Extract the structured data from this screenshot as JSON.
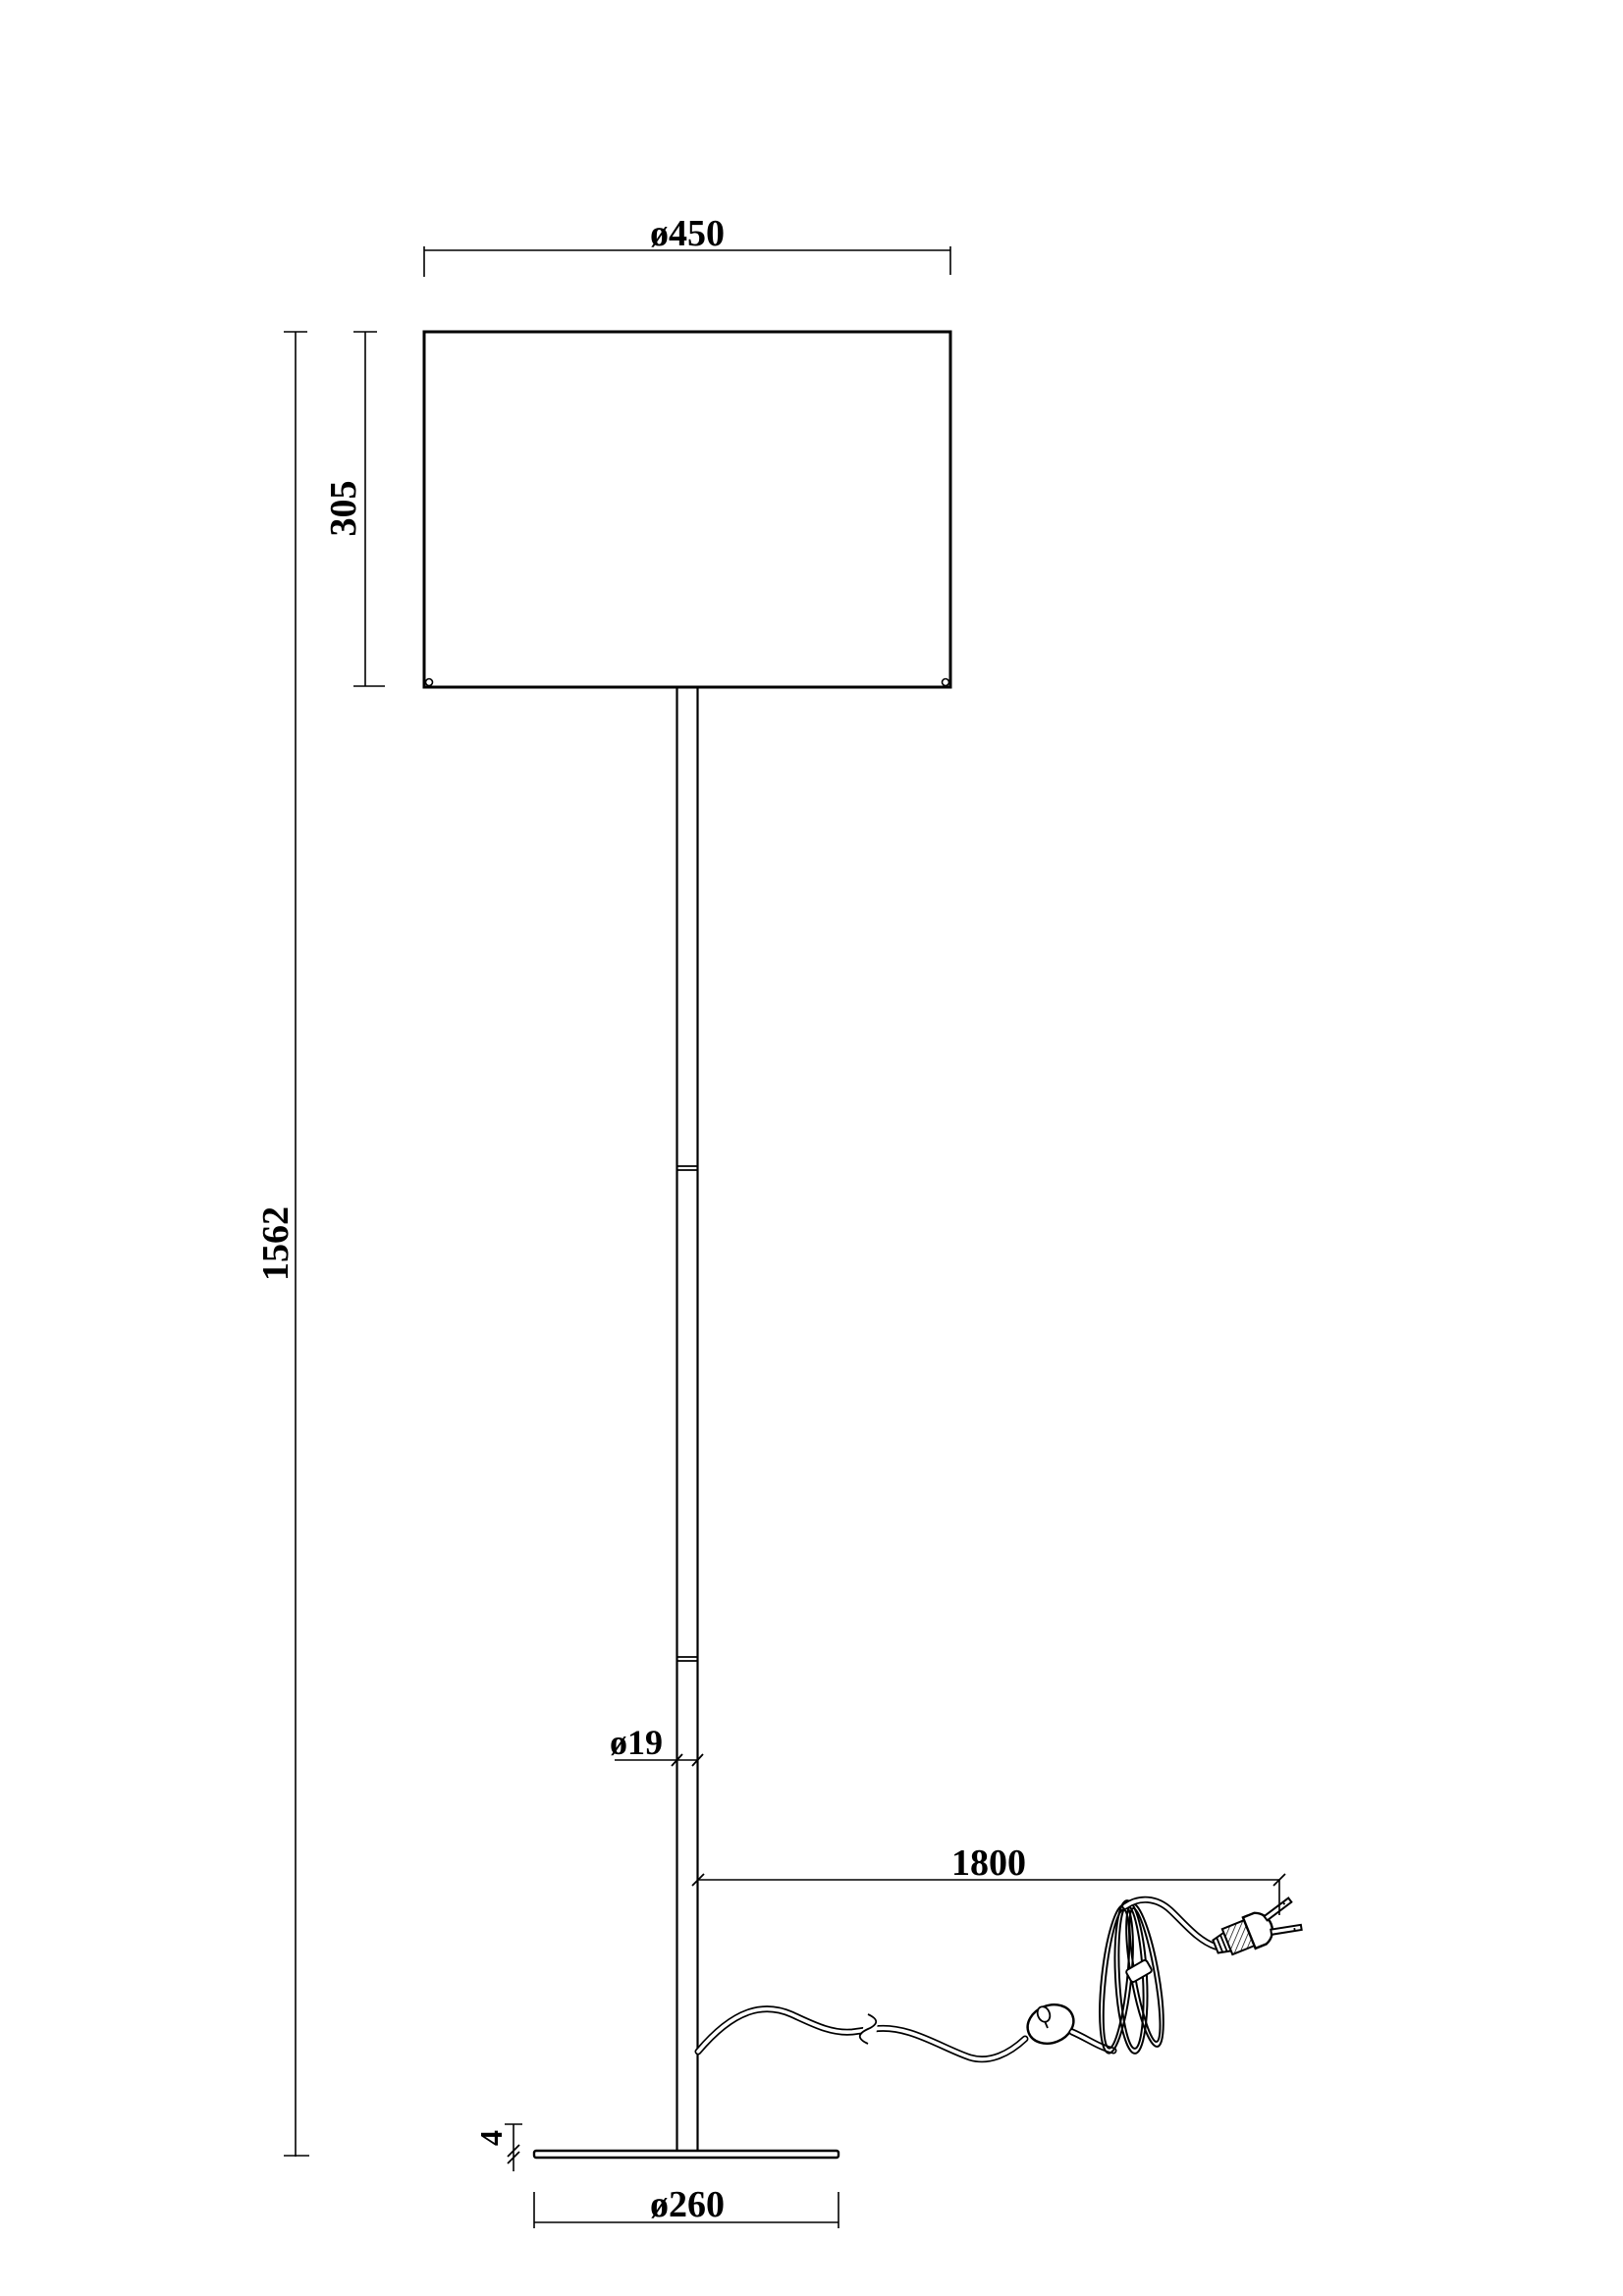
{
  "drawing": {
    "background": "#ffffff",
    "line_color": "#000000",
    "labels": {
      "shade_diameter": "ø450",
      "shade_height": "305",
      "total_height": "1562",
      "pole_diameter": "ø19",
      "cord_length": "1800",
      "base_thickness": "4",
      "base_diameter": "ø260"
    }
  }
}
